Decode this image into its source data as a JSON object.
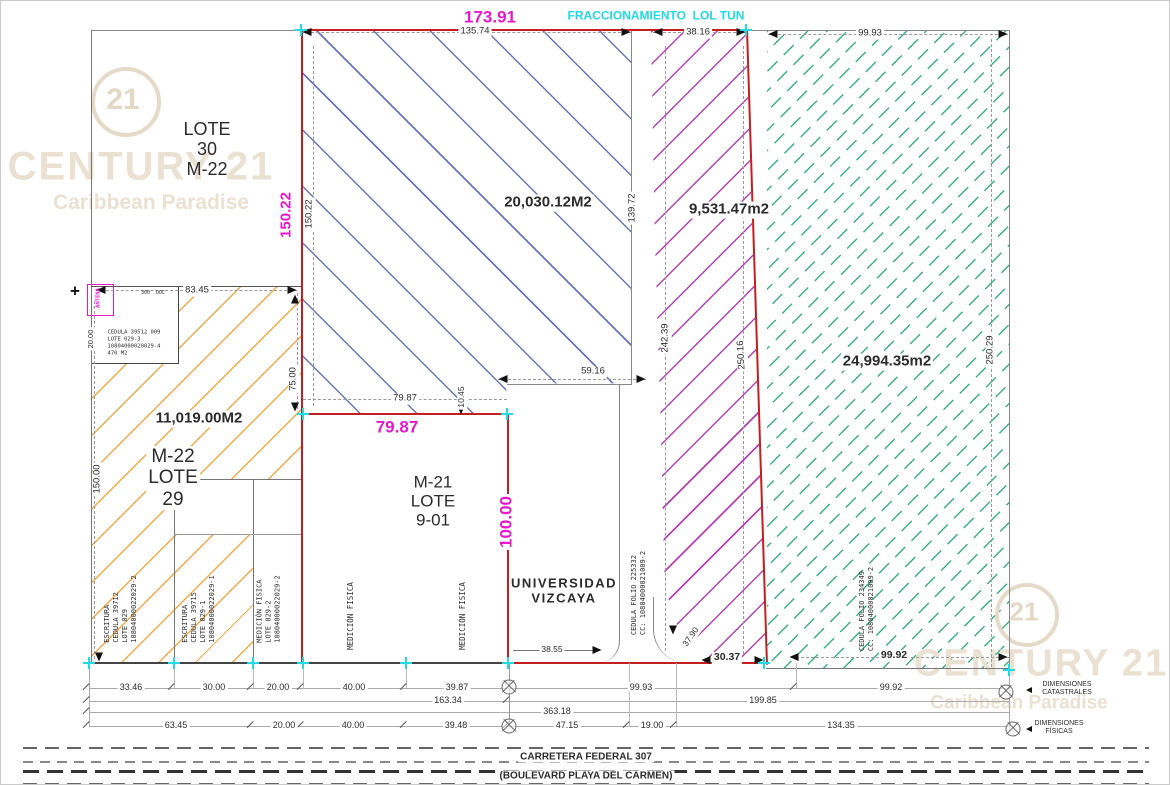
{
  "meta": {
    "width": 1170,
    "height": 785,
    "drawing_type": "cadastral survey plan"
  },
  "colors": {
    "red": "#c41e1e",
    "magenta": "#e718c9",
    "cyan": "#22d8e2",
    "blue": "#5f6fb4",
    "purple": "#b136b1",
    "green": "#2fae79",
    "orange": "#f0a53d",
    "watermark": "#eae1d2",
    "dim_text": "#2b2b2b"
  },
  "watermark": {
    "brand": "CENTURY 21",
    "sub": "Caribbean Paradise",
    "logo": "21"
  },
  "parcels": [
    {
      "id": "lote-30",
      "label": "LOTE 30 M-22"
    },
    {
      "id": "lote-29",
      "label": "M-22 LOTE 29",
      "area": "11,019.00M2",
      "hatch": "orange"
    },
    {
      "id": "fracc-blue",
      "area": "20,030.12M2",
      "hatch": "blue"
    },
    {
      "id": "fracc-purple",
      "area": "9,531.47m2",
      "hatch": "purple"
    },
    {
      "id": "fracc-green",
      "area": "24,994.35m2",
      "hatch": "green"
    },
    {
      "id": "lote-9-01",
      "label": "M-21 LOTE 9-01"
    },
    {
      "id": "universidad",
      "label": "UNIVERSIDAD VIZCAYA"
    }
  ],
  "labels": [
    {
      "n": "watermark-logo-21-top",
      "t": "21",
      "x": 122,
      "y": 99,
      "s": 30,
      "c": "#e3d8c4",
      "w": 700,
      "z": 3
    },
    {
      "n": "watermark-brand-top",
      "t": "CENTURY 21",
      "x": 140,
      "y": 166,
      "s": 40,
      "c": "#eae1d2",
      "w": 700,
      "ls": 2,
      "z": 3
    },
    {
      "n": "watermark-sub-top",
      "t": "Caribbean Paradise",
      "x": 150,
      "y": 202,
      "s": 21,
      "c": "#eae1d2",
      "w": 700,
      "z": 3
    },
    {
      "n": "watermark-logo-21-bottom",
      "t": "21",
      "x": 1023,
      "y": 611,
      "s": 26,
      "c": "#e3d8c4",
      "w": 700,
      "z": 3
    },
    {
      "n": "watermark-brand-bottom",
      "t": "CENTURY 21",
      "x": 1040,
      "y": 663,
      "s": 38,
      "c": "#eae1d2",
      "w": 700,
      "ls": 2,
      "z": 3
    },
    {
      "n": "watermark-sub-bottom",
      "t": "Caribbean Paradise",
      "x": 1018,
      "y": 702,
      "s": 19,
      "c": "#eae1d2",
      "w": 700,
      "z": 3
    },
    {
      "n": "dim-overall-top",
      "t": "173.91",
      "x": 489,
      "y": 16,
      "s": 17,
      "c": "#e718c9",
      "w": 700,
      "b": 1
    },
    {
      "n": "fraccionamiento-label",
      "t": "FRACCIONAMIENTO  LOL TUN",
      "x": 655,
      "y": 15,
      "s": 12,
      "c": "#22d8e2",
      "w": 700
    },
    {
      "n": "dim-top-1",
      "t": "135.74",
      "x": 474,
      "y": 31,
      "s": 9.5,
      "b": 1
    },
    {
      "n": "dim-top-2",
      "t": "38.16",
      "x": 697,
      "y": 32,
      "s": 9.5,
      "b": 1
    },
    {
      "n": "dim-top-3",
      "t": "99.93",
      "x": 869,
      "y": 33,
      "s": 9.5,
      "b": 1
    },
    {
      "n": "lote-30-label",
      "t": "LOTE\n30\nM-22",
      "x": 206,
      "y": 148,
      "s": 18
    },
    {
      "n": "area-blue",
      "t": "20,030.12M2",
      "x": 547,
      "y": 202,
      "s": 15,
      "w": 700,
      "b": 1
    },
    {
      "n": "area-purple",
      "t": "9,531.47m2",
      "x": 728,
      "y": 209,
      "s": 15,
      "w": 700,
      "b": 1
    },
    {
      "n": "area-green",
      "t": "24,994.35m2",
      "x": 886,
      "y": 361,
      "s": 15,
      "w": 700,
      "b": 1
    },
    {
      "n": "area-orange",
      "t": "11,019.00M2",
      "x": 198,
      "y": 418,
      "s": 15,
      "w": 700,
      "b": 1
    },
    {
      "n": "lote-29-label",
      "t": "M-22\nLOTE\n29",
      "x": 172,
      "y": 477,
      "s": 19,
      "b": 1
    },
    {
      "n": "lote-9-01-label",
      "t": "M-21\nLOTE\n9-01",
      "x": 432,
      "y": 500,
      "s": 17
    },
    {
      "n": "universidad-label",
      "t": "UNIVERSIDAD\nVIZCAYA",
      "x": 563,
      "y": 590,
      "s": 13,
      "w": 700,
      "ls": 1.5
    },
    {
      "n": "dim-magenta-left",
      "t": "150.22",
      "x": 286,
      "y": 214,
      "s": 15,
      "c": "#e718c9",
      "w": 700,
      "r": -90,
      "b": 1
    },
    {
      "n": "dim-magenta-7987",
      "t": "79.87",
      "x": 396,
      "y": 426,
      "s": 17,
      "c": "#e718c9",
      "w": 700
    },
    {
      "n": "dim-magenta-100",
      "t": "100.00",
      "x": 505,
      "y": 521,
      "s": 17,
      "c": "#e718c9",
      "w": 700,
      "r": -90,
      "b": 1
    },
    {
      "n": "dim-v",
      "t": "150.22",
      "x": 309,
      "y": 213,
      "s": 9.5,
      "r": -90,
      "b": 1
    },
    {
      "n": "dim-v",
      "t": "139.72",
      "x": 632,
      "y": 207,
      "s": 9.5,
      "r": -90,
      "b": 1
    },
    {
      "n": "dim-v",
      "t": "242.39",
      "x": 665,
      "y": 337,
      "s": 9.5,
      "r": -90,
      "b": 1
    },
    {
      "n": "dim-v",
      "t": "250.16",
      "x": 741,
      "y": 354,
      "s": 9.5,
      "r": -93,
      "b": 1
    },
    {
      "n": "dim-v",
      "t": "250.29",
      "x": 990,
      "y": 349,
      "s": 9.5,
      "r": -90,
      "b": 1
    },
    {
      "n": "dim-v",
      "t": "150.00",
      "x": 97,
      "y": 478,
      "s": 9.5,
      "r": -90,
      "b": 1
    },
    {
      "n": "dim-v",
      "t": "75.00",
      "x": 293,
      "y": 378,
      "s": 9.5,
      "r": -90,
      "b": 1
    },
    {
      "n": "dim-v",
      "t": "10.45",
      "x": 461,
      "y": 396,
      "s": 8.5,
      "r": -90,
      "b": 1
    },
    {
      "n": "dim-v",
      "t": "20.00",
      "x": 90,
      "y": 338,
      "s": 7.5,
      "r": -90,
      "b": 1
    },
    {
      "n": "dim-h",
      "t": "83.45",
      "x": 196,
      "y": 290,
      "s": 9.5,
      "b": 1
    },
    {
      "n": "dim-h",
      "t": "79.87",
      "x": 404,
      "y": 398,
      "s": 9.5,
      "b": 1
    },
    {
      "n": "dim-h",
      "t": "59.16",
      "x": 592,
      "y": 371,
      "s": 9.5,
      "b": 1
    },
    {
      "n": "dim-h",
      "t": "38.55",
      "x": 551,
      "y": 649,
      "s": 8.5,
      "b": 1
    },
    {
      "n": "dim-h",
      "t": "30.37",
      "x": 726,
      "y": 657,
      "s": 10.5,
      "w": 700,
      "b": 1
    },
    {
      "n": "dim-h",
      "t": "37.90",
      "x": 690,
      "y": 636,
      "s": 8.5,
      "r": -55,
      "b": 1
    },
    {
      "n": "dim-h",
      "t": "99.92",
      "x": 893,
      "y": 655,
      "s": 10.5,
      "w": 700,
      "b": 1
    },
    {
      "n": "escritura-col-1",
      "t": "ESCRITURA\nCEDULA 39712\nLOTE 029\n10804000022029-2",
      "x": 120,
      "y": 608,
      "s": 7,
      "r": -90,
      "m": 1
    },
    {
      "n": "escritura-col-2",
      "t": "ESCRITURA\nCEDULA 39715\nLOTE 029-1\n10804000022029-1",
      "x": 198,
      "y": 608,
      "s": 7,
      "r": -90,
      "m": 1
    },
    {
      "n": "medicion-col-1",
      "t": "MEDICIÓN FISICA\nLOTE 029-2\n10804000022029-2",
      "x": 268,
      "y": 608,
      "s": 7,
      "r": -90,
      "m": 1
    },
    {
      "n": "medicion-col-2",
      "t": "MEDICIÓN FISICA",
      "x": 350,
      "y": 615,
      "s": 7.5,
      "r": -90,
      "m": 1
    },
    {
      "n": "medicion-col-3",
      "t": "MEDICIÓN FISICA",
      "x": 462,
      "y": 615,
      "s": 7.5,
      "r": -90,
      "m": 1
    },
    {
      "n": "cedula-universidad",
      "t": "CEDULA FOLIO 225332\nCC: 10804000021009-2",
      "x": 638,
      "y": 592,
      "s": 7,
      "r": -90,
      "m": 1
    },
    {
      "n": "cedula-green",
      "t": "CEDULA FOLIO 234349\nCC: 10804000021009-2",
      "x": 866,
      "y": 608,
      "s": 7,
      "r": -90,
      "m": 1
    },
    {
      "n": "detail-box-text",
      "t": "CEDULA 39512 009\nLOTE 029-3\n10804000020029-4\n470 M2",
      "x": 133,
      "y": 343,
      "s": 5.5,
      "m": 1
    },
    {
      "n": "antena-label",
      "t": "ANTENA",
      "x": 98,
      "y": 297,
      "s": 5.5,
      "c": "#e718c9",
      "w": 700,
      "r": -90,
      "m": 1
    },
    {
      "n": "detail-box-top-text",
      "t": "300  DOC",
      "x": 152,
      "y": 292,
      "s": 5,
      "m": 1
    },
    {
      "n": "detail-box-marker",
      "t": "+",
      "x": 74,
      "y": 290,
      "s": 17,
      "w": 700,
      "c": "#111"
    },
    {
      "n": "dim-cat",
      "t": "33.46",
      "x": 130,
      "y": 686,
      "s": 9,
      "b": 1
    },
    {
      "n": "dim-cat",
      "t": "30.00",
      "x": 213,
      "y": 686,
      "s": 9,
      "b": 1
    },
    {
      "n": "dim-cat",
      "t": "20.00",
      "x": 277,
      "y": 686,
      "s": 9,
      "b": 1
    },
    {
      "n": "dim-cat",
      "t": "40.00",
      "x": 353,
      "y": 686,
      "s": 9,
      "b": 1
    },
    {
      "n": "dim-cat",
      "t": "39.87",
      "x": 456,
      "y": 686,
      "s": 9,
      "b": 1
    },
    {
      "n": "dim-cat",
      "t": "99.93",
      "x": 640,
      "y": 686,
      "s": 9,
      "b": 1
    },
    {
      "n": "dim-cat",
      "t": "99.92",
      "x": 890,
      "y": 686,
      "s": 9,
      "b": 1
    },
    {
      "n": "dim-subtotal",
      "t": "163.34",
      "x": 447,
      "y": 699,
      "s": 9,
      "b": 1
    },
    {
      "n": "dim-subtotal",
      "t": "199.85",
      "x": 762,
      "y": 699,
      "s": 9,
      "b": 1
    },
    {
      "n": "dim-total",
      "t": "363.18",
      "x": 556,
      "y": 710,
      "s": 9,
      "b": 1
    },
    {
      "n": "dim-fis",
      "t": "63.45",
      "x": 175,
      "y": 724,
      "s": 9,
      "b": 1
    },
    {
      "n": "dim-fis",
      "t": "20.00",
      "x": 283,
      "y": 724,
      "s": 9,
      "b": 1
    },
    {
      "n": "dim-fis",
      "t": "40.00",
      "x": 352,
      "y": 724,
      "s": 9,
      "b": 1
    },
    {
      "n": "dim-fis",
      "t": "39.48",
      "x": 455,
      "y": 724,
      "s": 9,
      "b": 1
    },
    {
      "n": "dim-fis",
      "t": "47.15",
      "x": 566,
      "y": 724,
      "s": 9,
      "b": 1
    },
    {
      "n": "dim-fis",
      "t": "19.00",
      "x": 651,
      "y": 724,
      "s": 9,
      "b": 1
    },
    {
      "n": "dim-fis",
      "t": "134.35",
      "x": 840,
      "y": 724,
      "s": 9,
      "b": 1
    },
    {
      "n": "dimensiones-catastrales-label",
      "t": "DIMENSIONES\nCATASTRALES",
      "x": 1066,
      "y": 688,
      "s": 7
    },
    {
      "n": "dimensiones-fisicas-label",
      "t": "DIMENSIONES\nFÍSICAS",
      "x": 1058,
      "y": 727,
      "s": 7
    },
    {
      "n": "road-name",
      "t": "CARRETERA FEDERAL 307",
      "x": 585,
      "y": 756,
      "s": 10,
      "w": 700,
      "b": 1
    },
    {
      "n": "road-alt-name",
      "t": "(BOULEVARD PLAYA DEL CARMEN)",
      "x": 585,
      "y": 775,
      "s": 10,
      "w": 700,
      "b": 1
    }
  ],
  "lines": [
    {
      "x": 90,
      "y": 29,
      "w": 1,
      "h": 634,
      "c": "#777"
    },
    {
      "x": 90,
      "y": 29,
      "w": 211,
      "h": 1,
      "c": "#888"
    },
    {
      "x": 90,
      "y": 285,
      "w": 212,
      "h": 1,
      "c": "#555"
    },
    {
      "x": 765,
      "y": 29,
      "w": 244,
      "h": 1,
      "c": "#888"
    },
    {
      "x": 1008,
      "y": 29,
      "w": 1,
      "h": 640,
      "c": "#888"
    },
    {
      "x": 765,
      "y": 667,
      "w": 244,
      "h": 1,
      "c": "#777"
    },
    {
      "x": 630,
      "y": 29,
      "w": 1,
      "h": 355,
      "c": "#888"
    },
    {
      "x": 506,
      "y": 383,
      "w": 125,
      "h": 1,
      "c": "#888"
    },
    {
      "x": 618,
      "y": 383,
      "w": 1,
      "h": 238,
      "c": "#888"
    },
    {
      "x": 173,
      "y": 478,
      "w": 1,
      "h": 184,
      "c": "#777"
    },
    {
      "x": 252,
      "y": 478,
      "w": 1,
      "h": 184,
      "c": "#777"
    },
    {
      "x": 173,
      "y": 478,
      "w": 128,
      "h": 1,
      "c": "#777"
    },
    {
      "x": 173,
      "y": 533,
      "w": 128,
      "h": 1,
      "c": "#999"
    },
    {
      "x": 86,
      "y": 661,
      "w": 424,
      "h": 2,
      "c": "#444"
    },
    {
      "x": 745,
      "y": 29,
      "w": 21,
      "h": 1,
      "c": "#888"
    },
    {
      "x": 300,
      "y": 28,
      "w": 447,
      "h": 2,
      "c": "#c41e1e"
    },
    {
      "x": 300,
      "y": 28,
      "w": 2,
      "h": 635,
      "c": "#c41e1e"
    },
    {
      "x": 300,
      "y": 412,
      "w": 208,
      "h": 2,
      "c": "#c41e1e"
    },
    {
      "x": 506,
      "y": 412,
      "w": 2,
      "h": 251,
      "c": "#c41e1e"
    },
    {
      "x": 506,
      "y": 661,
      "w": 261,
      "h": 2,
      "c": "#c41e1e"
    },
    {
      "x": 745,
      "y": 28,
      "w": 2,
      "h": 636,
      "c": "#c41e1e",
      "r": -1.8
    },
    {
      "x": 312,
      "y": 45,
      "w": 1,
      "h": 360,
      "d": 1
    },
    {
      "x": 93,
      "y": 300,
      "w": 1,
      "h": 358,
      "d": 1
    },
    {
      "x": 296,
      "y": 292,
      "w": 1,
      "h": 116,
      "d": 1
    },
    {
      "x": 664,
      "y": 45,
      "w": 1,
      "h": 605,
      "d": 1
    },
    {
      "x": 742,
      "y": 45,
      "w": 1,
      "h": 608,
      "d": 1
    },
    {
      "x": 990,
      "y": 38,
      "w": 1,
      "h": 628,
      "d": 1
    },
    {
      "x": 460,
      "y": 384,
      "w": 1,
      "h": 27,
      "d": 1
    },
    {
      "x": 300,
      "y": 31,
      "w": 330,
      "h": 1,
      "d": 1
    },
    {
      "x": 652,
      "y": 31,
      "w": 93,
      "h": 1,
      "d": 1
    },
    {
      "x": 767,
      "y": 33,
      "w": 240,
      "h": 1,
      "d": 1
    },
    {
      "x": 95,
      "y": 289,
      "w": 201,
      "h": 1,
      "d": 1
    },
    {
      "x": 497,
      "y": 378,
      "w": 148,
      "h": 1,
      "d": 1
    },
    {
      "x": 302,
      "y": 398,
      "w": 204,
      "h": 1,
      "d": 1
    },
    {
      "x": 512,
      "y": 649,
      "w": 86,
      "h": 1,
      "c": "#777"
    },
    {
      "x": 790,
      "y": 656,
      "w": 218,
      "h": 1,
      "d": 1
    },
    {
      "x": 88,
      "y": 687,
      "w": 920,
      "h": 1,
      "c": "#aaa"
    },
    {
      "x": 88,
      "y": 700,
      "w": 920,
      "h": 1,
      "c": "#aaa"
    },
    {
      "x": 88,
      "y": 711,
      "w": 920,
      "h": 1,
      "c": "#aaa"
    },
    {
      "x": 88,
      "y": 725,
      "w": 920,
      "h": 1,
      "c": "#aaa"
    },
    {
      "x": 88,
      "y": 662,
      "w": 1,
      "h": 64,
      "c": "#aaa"
    },
    {
      "x": 1008,
      "y": 668,
      "w": 1,
      "h": 62,
      "c": "#aaa"
    },
    {
      "x": 508,
      "y": 662,
      "w": 1,
      "h": 64,
      "c": "#999"
    },
    {
      "x": 173,
      "y": 662,
      "w": 1,
      "h": 25,
      "c": "#bbb"
    },
    {
      "x": 252,
      "y": 662,
      "w": 1,
      "h": 25,
      "c": "#bbb"
    },
    {
      "x": 302,
      "y": 662,
      "w": 1,
      "h": 25,
      "c": "#bbb"
    },
    {
      "x": 405,
      "y": 662,
      "w": 1,
      "h": 25,
      "c": "#bbb"
    },
    {
      "x": 795,
      "y": 662,
      "w": 1,
      "h": 25,
      "c": "#bbb"
    },
    {
      "x": 628,
      "y": 662,
      "w": 1,
      "h": 63,
      "c": "#bbb"
    },
    {
      "x": 675,
      "y": 662,
      "w": 1,
      "h": 63,
      "c": "#bbb"
    },
    {
      "x": 88,
      "y": 682,
      "w": 1.4,
      "h": 9,
      "c": "#555",
      "r": 45
    },
    {
      "x": 173,
      "y": 682,
      "w": 1.4,
      "h": 9,
      "c": "#555",
      "r": 45
    },
    {
      "x": 252,
      "y": 682,
      "w": 1.4,
      "h": 9,
      "c": "#555",
      "r": 45
    },
    {
      "x": 302,
      "y": 682,
      "w": 1.4,
      "h": 9,
      "c": "#555",
      "r": 45
    },
    {
      "x": 405,
      "y": 682,
      "w": 1.4,
      "h": 9,
      "c": "#555",
      "r": 45
    },
    {
      "x": 795,
      "y": 682,
      "w": 1.4,
      "h": 9,
      "c": "#555",
      "r": 45
    },
    {
      "x": 88,
      "y": 695,
      "w": 1.4,
      "h": 9,
      "c": "#555",
      "r": 45
    },
    {
      "x": 508,
      "y": 695,
      "w": 1.4,
      "h": 9,
      "c": "#555",
      "r": 45
    },
    {
      "x": 88,
      "y": 706,
      "w": 1.4,
      "h": 9,
      "c": "#555",
      "r": 45
    },
    {
      "x": 88,
      "y": 720,
      "w": 1.4,
      "h": 9,
      "c": "#555",
      "r": 45
    },
    {
      "x": 252,
      "y": 720,
      "w": 1.4,
      "h": 9,
      "c": "#555",
      "r": 45
    },
    {
      "x": 302,
      "y": 720,
      "w": 1.4,
      "h": 9,
      "c": "#555",
      "r": 45
    },
    {
      "x": 405,
      "y": 720,
      "w": 1.4,
      "h": 9,
      "c": "#555",
      "r": 45
    },
    {
      "x": 508,
      "y": 720,
      "w": 1.4,
      "h": 9,
      "c": "#555",
      "r": 45
    },
    {
      "x": 628,
      "y": 720,
      "w": 1.4,
      "h": 9,
      "c": "#555",
      "r": 45
    },
    {
      "x": 675,
      "y": 720,
      "w": 1.4,
      "h": 9,
      "c": "#555",
      "r": 45
    }
  ],
  "arrows": [
    {
      "x": 306,
      "y": 31,
      "d": "l"
    },
    {
      "x": 625,
      "y": 31,
      "d": "r"
    },
    {
      "x": 657,
      "y": 31,
      "d": "l"
    },
    {
      "x": 740,
      "y": 31,
      "d": "r"
    },
    {
      "x": 772,
      "y": 33,
      "d": "l"
    },
    {
      "x": 1002,
      "y": 33,
      "d": "r"
    },
    {
      "x": 100,
      "y": 289,
      "d": "l"
    },
    {
      "x": 291,
      "y": 289,
      "d": "r"
    },
    {
      "x": 294,
      "y": 298,
      "d": "u"
    },
    {
      "x": 294,
      "y": 406,
      "d": "d"
    },
    {
      "x": 502,
      "y": 378,
      "d": "l"
    },
    {
      "x": 640,
      "y": 378,
      "d": "r"
    },
    {
      "x": 460,
      "y": 409,
      "d": "d"
    },
    {
      "x": 596,
      "y": 649,
      "d": "r"
    },
    {
      "x": 705,
      "y": 659,
      "d": "l"
    },
    {
      "x": 758,
      "y": 659,
      "d": "r"
    },
    {
      "x": 793,
      "y": 656,
      "d": "l"
    },
    {
      "x": 1002,
      "y": 656,
      "d": "r"
    },
    {
      "x": 672,
      "y": 629,
      "d": "d"
    },
    {
      "x": 98,
      "y": 656,
      "d": "d"
    },
    {
      "x": 1028,
      "y": 689,
      "d": "l",
      "sm": 1
    },
    {
      "x": 1028,
      "y": 728,
      "d": "l",
      "sm": 1
    }
  ],
  "cyan_markers": [
    {
      "x": 300,
      "y": 29
    },
    {
      "x": 745,
      "y": 29
    },
    {
      "x": 302,
      "y": 413
    },
    {
      "x": 506,
      "y": 413
    },
    {
      "x": 88,
      "y": 662
    },
    {
      "x": 173,
      "y": 662
    },
    {
      "x": 252,
      "y": 662
    },
    {
      "x": 302,
      "y": 662
    },
    {
      "x": 405,
      "y": 662
    },
    {
      "x": 507,
      "y": 662
    },
    {
      "x": 763,
      "y": 662
    },
    {
      "x": 1008,
      "y": 669
    }
  ],
  "datum_circles": [
    {
      "x": 508,
      "y": 686
    },
    {
      "x": 508,
      "y": 725
    },
    {
      "x": 1005,
      "y": 691
    },
    {
      "x": 1012,
      "y": 728
    }
  ]
}
